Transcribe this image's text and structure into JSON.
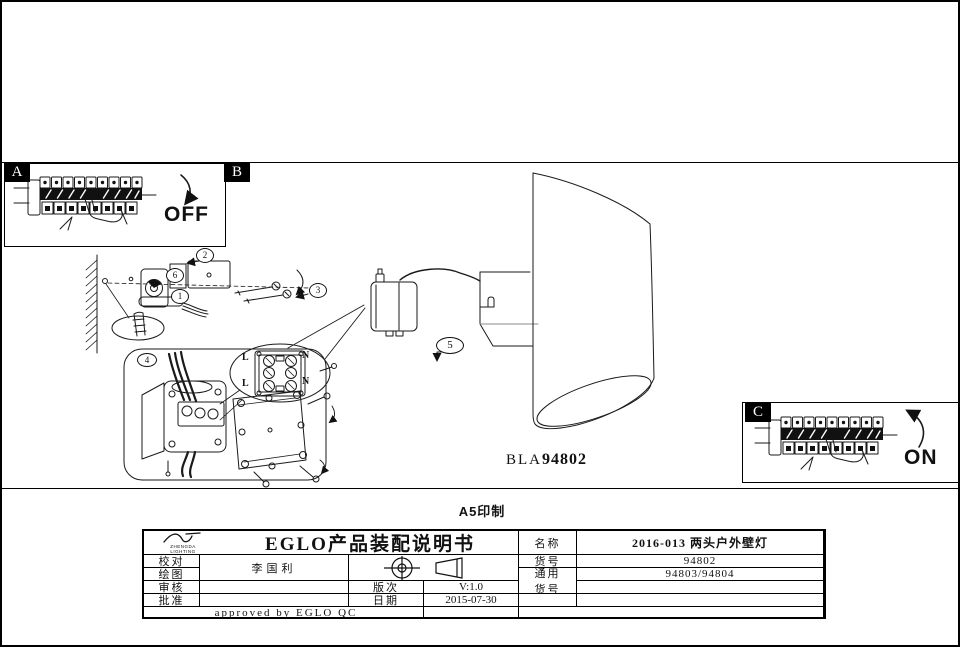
{
  "colors": {
    "ink": "#111111",
    "paper": "#ffffff"
  },
  "page": {
    "print_note": "A5印制",
    "model_prefix": "BLA",
    "model_number": "94802"
  },
  "panels": {
    "a": {
      "label": "A",
      "state": "OFF"
    },
    "b": {
      "label": "B"
    },
    "c": {
      "label": "C",
      "state": "ON"
    }
  },
  "callouts": {
    "c1": "1",
    "c2": "2",
    "c3": "3",
    "c4": "4",
    "c5": "5",
    "c6": "6"
  },
  "terminal": {
    "l_top": "L",
    "l_bottom": "L",
    "n_top": "N",
    "n_bottom": "N"
  },
  "title_block": {
    "logo_top": "ZHENGDA",
    "logo_bottom": "LIGHTING",
    "title": "EGLO产品装配说明书",
    "check_label": "校对",
    "draw_label": "绘图",
    "drafter": "李国利",
    "review_label": "审核",
    "approve_label": "批准",
    "version_label": "版次",
    "version_value": "V:1.0",
    "date_label": "日期",
    "date_value": "2015-07-30",
    "name_label": "名称",
    "name_value": "2016-013 两头户外壁灯",
    "item_label": "货号",
    "item_value": "94802",
    "common_label_1": "通用",
    "common_label_2": "货号",
    "common_value": "94803/94804",
    "approved_note": "approved by EGLO QC"
  }
}
